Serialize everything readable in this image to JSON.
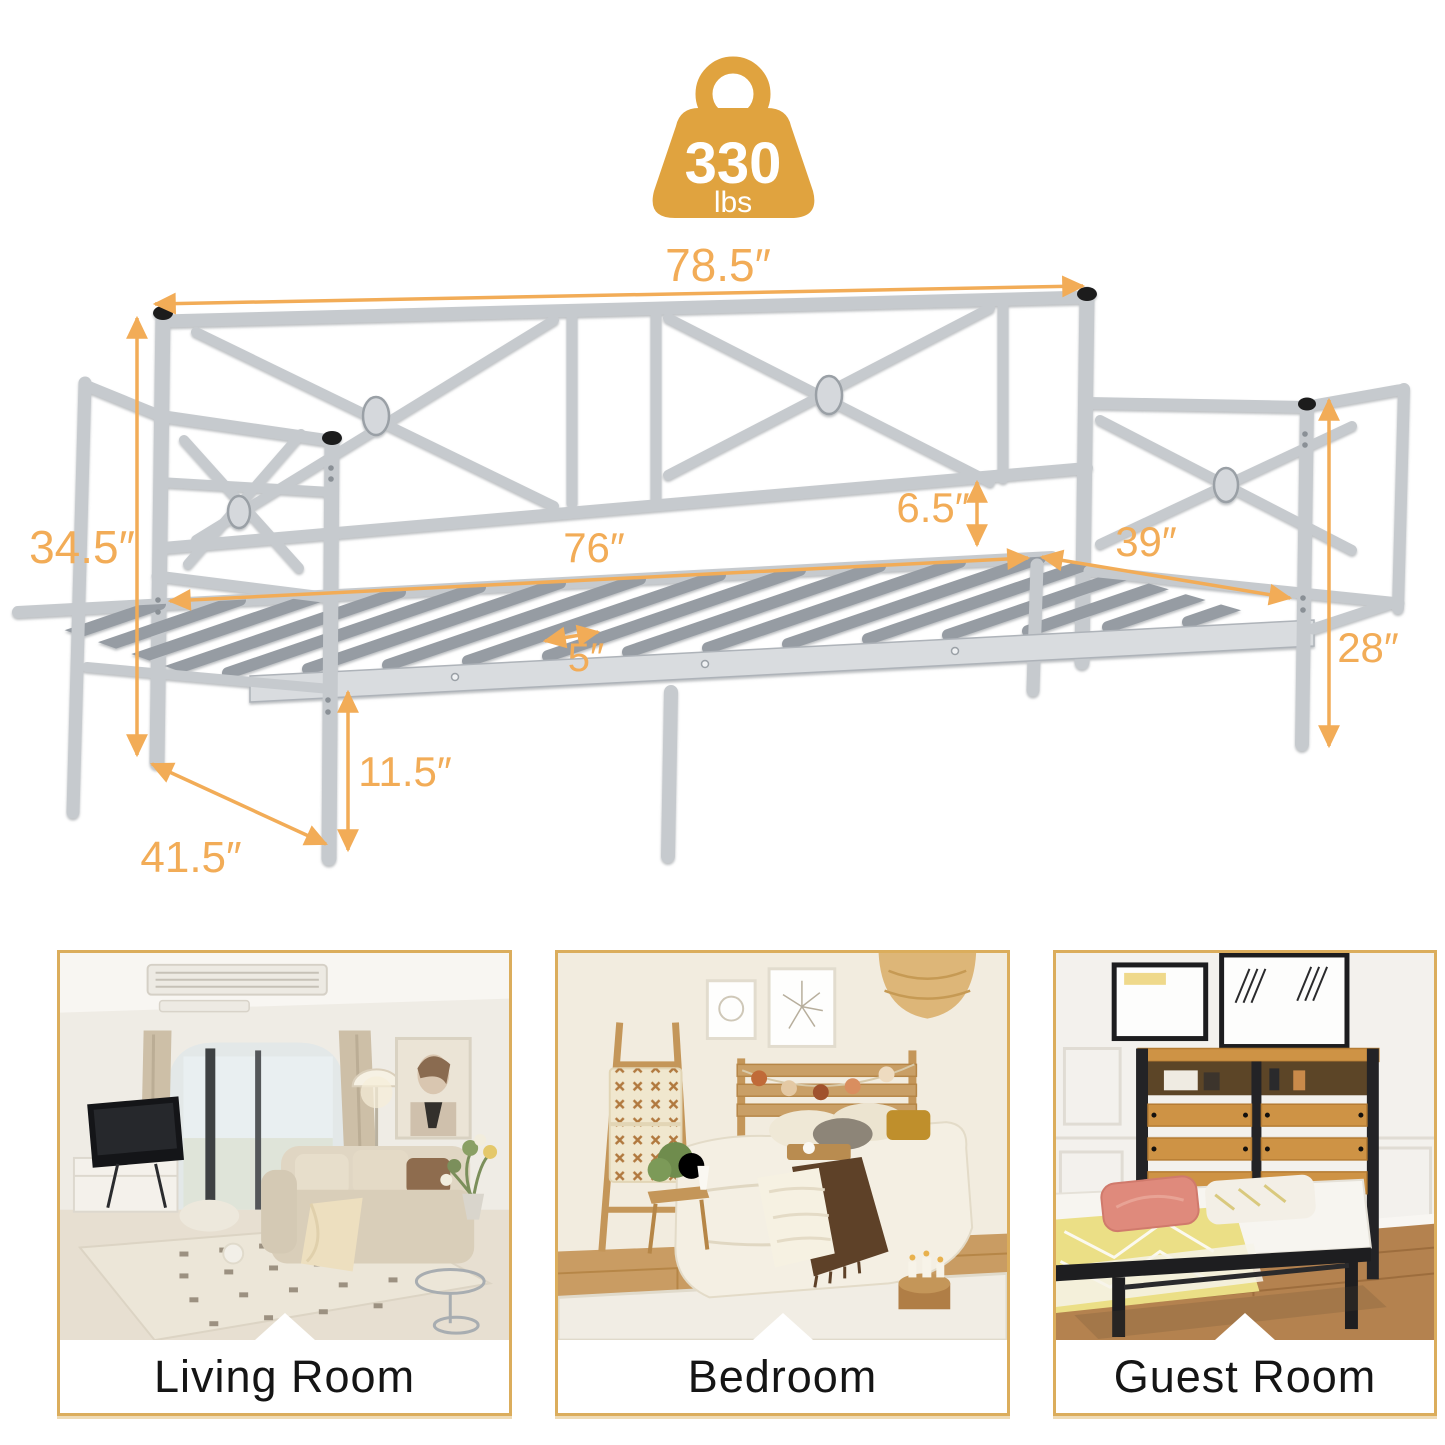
{
  "weight_badge": {
    "value": "330",
    "unit": "lbs",
    "icon": "weight-icon"
  },
  "dimensions": {
    "overall_length": "78.5″",
    "overall_height": "34.5″",
    "backrest_to_deck": "6.5″",
    "sleeping_length": "76″",
    "sleeping_width": "39″",
    "arm_height": "28″",
    "slat_spacing": "5″",
    "under_bed_clearance": "11.5″",
    "overall_depth": "41.5″"
  },
  "rooms": [
    {
      "label": "Living Room"
    },
    {
      "label": "Bedroom"
    },
    {
      "label": "Guest Room"
    }
  ],
  "colors": {
    "dimension_accent": "#F2AC57",
    "badge_gold": "#E0A33F",
    "metal_silver": "#C6CACE",
    "card_border": "#DBAD5C"
  }
}
